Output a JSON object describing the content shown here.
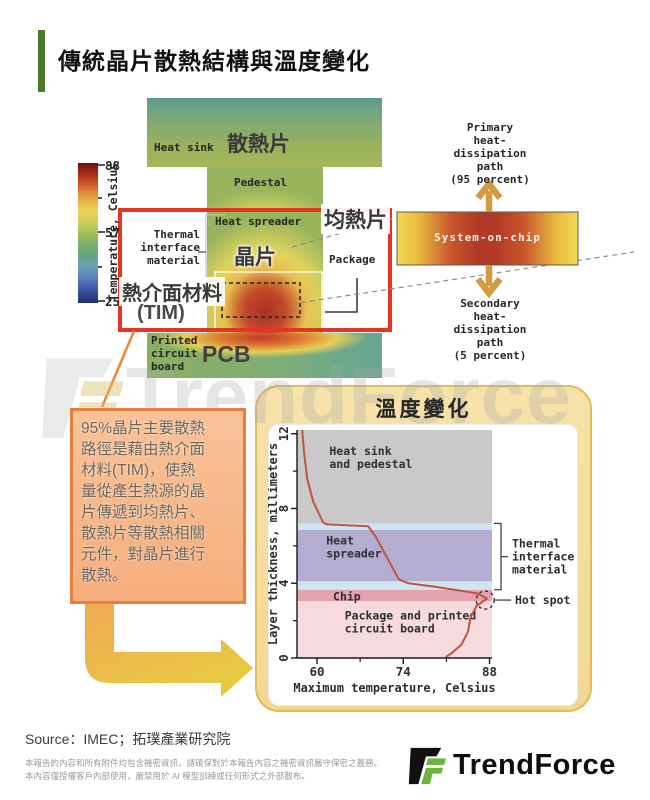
{
  "header": {
    "title": "傳統晶片散熱結構與溫度變化"
  },
  "thermal_diagram": {
    "colorbar": {
      "label": "Temperature, Celsius",
      "ticks": [
        "88",
        "57",
        "25"
      ]
    },
    "labels": {
      "heat_sink_en": "Heat sink",
      "heat_sink_zh": "散熱片",
      "pedestal": "Pedestal",
      "heat_spreader_en": "Heat spreader",
      "heat_spreader_zh": "均熱片",
      "tim_en": "Thermal\ninterface\nmaterial",
      "tim_zh": "熱介面材料",
      "tim_suffix": "(TIM)",
      "chip_zh": "晶片",
      "package": "Package",
      "pcb_en": "Printed\ncircuit\nboard",
      "pcb_zh": "PCB"
    },
    "soc_inset": {
      "label": "System-on-chip",
      "primary_path": "Primary\nheat-\ndissipation\npath\n(95 percent)",
      "secondary_path": "Secondary\nheat-\ndissipation\npath\n(5 percent)"
    },
    "colors": {
      "highlight_box_red": "#e53422",
      "arrow_gold": "#d49a3f",
      "connector_orange": "#f08437"
    }
  },
  "callout": {
    "text": "95%晶片主要散熱\n路徑是藉由熱介面\n材料(TIM)，使熱\n量從產生熱源的晶\n片傳遞到均熱片、\n散熱片等散熱相關\n元件，對晶片進行\n散熱。"
  },
  "chart_card": {
    "title": "溫度變化",
    "bg_color": "#f3db9b"
  },
  "chart_data": {
    "type": "line",
    "title": "溫度變化",
    "xlabel": "Maximum temperature, Celsius",
    "ylabel": "Layer thickness, millimeters",
    "xlim": [
      56.75,
      88.4
    ],
    "ylim": [
      0,
      12.2
    ],
    "x_major_ticks": [
      60,
      74,
      88
    ],
    "x_minor_ticks": [
      67,
      81
    ],
    "y_major_ticks": [
      0,
      4,
      8,
      12
    ],
    "y_minor_ticks": [
      2,
      6,
      10
    ],
    "grid": false,
    "regions": [
      {
        "name": "Heat sink\nand pedestal",
        "from": 7.2,
        "to": 12.2,
        "color": "#c9c9c9",
        "label_x": 62.0,
        "label_y": 11.35
      },
      {
        "name": "",
        "from": 6.85,
        "to": 7.2,
        "color": "#cfe6f2"
      },
      {
        "name": "Heat\nspreader",
        "from": 4.1,
        "to": 6.85,
        "color": "#b3add2",
        "label_x": 61.5,
        "label_y": 6.55
      },
      {
        "name": "",
        "from": 3.65,
        "to": 4.1,
        "color": "#cfe6f2"
      },
      {
        "name": "Chip",
        "from": 3.05,
        "to": 3.65,
        "color": "#e5a2ae",
        "label_x": 62.6,
        "label_y": 3.55
      },
      {
        "name": "Package and printed\ncircuit board",
        "from": 0,
        "to": 3.05,
        "color": "#f5dade",
        "label_x": 64.5,
        "label_y": 2.55
      }
    ],
    "line": {
      "color": "#bf5540",
      "points": [
        [
          57.6,
          12.2
        ],
        [
          57.9,
          11.0
        ],
        [
          58.4,
          9.6
        ],
        [
          59.4,
          8.35
        ],
        [
          61.0,
          7.25
        ],
        [
          61.6,
          7.15
        ],
        [
          68.3,
          7.05
        ],
        [
          69.5,
          6.5
        ],
        [
          73.3,
          4.2
        ],
        [
          74.8,
          4.0
        ],
        [
          79.0,
          3.82
        ],
        [
          83.0,
          3.62
        ],
        [
          86.0,
          3.45
        ],
        [
          87.6,
          3.18
        ],
        [
          86.6,
          2.95
        ],
        [
          85.9,
          2.8
        ],
        [
          84.9,
          2.15
        ],
        [
          84.5,
          1.4
        ],
        [
          83.4,
          0.7
        ],
        [
          82.0,
          0.3
        ],
        [
          80.9,
          0.05
        ]
      ]
    },
    "annotations": {
      "tim_bracket": {
        "label": "Thermal\ninterface\nmaterial",
        "from": 3.65,
        "to": 7.2
      },
      "hot_spot": {
        "label": "Hot spot",
        "x": 87.3,
        "y": 3.1
      }
    }
  },
  "footer": {
    "source": "Source：IMEC；拓璞產業研究院",
    "disclaimer": [
      "本報告的內容和所有附件均包含機密資訊，請確保對於本報告內容之機密資訊嚴守保密之義務。",
      "本內容僅授權客戶內部使用，嚴禁用於 AI 模型訓練或任何形式之外部散布。"
    ],
    "logo_text": "TrendForce"
  },
  "watermark": "TrendForce"
}
